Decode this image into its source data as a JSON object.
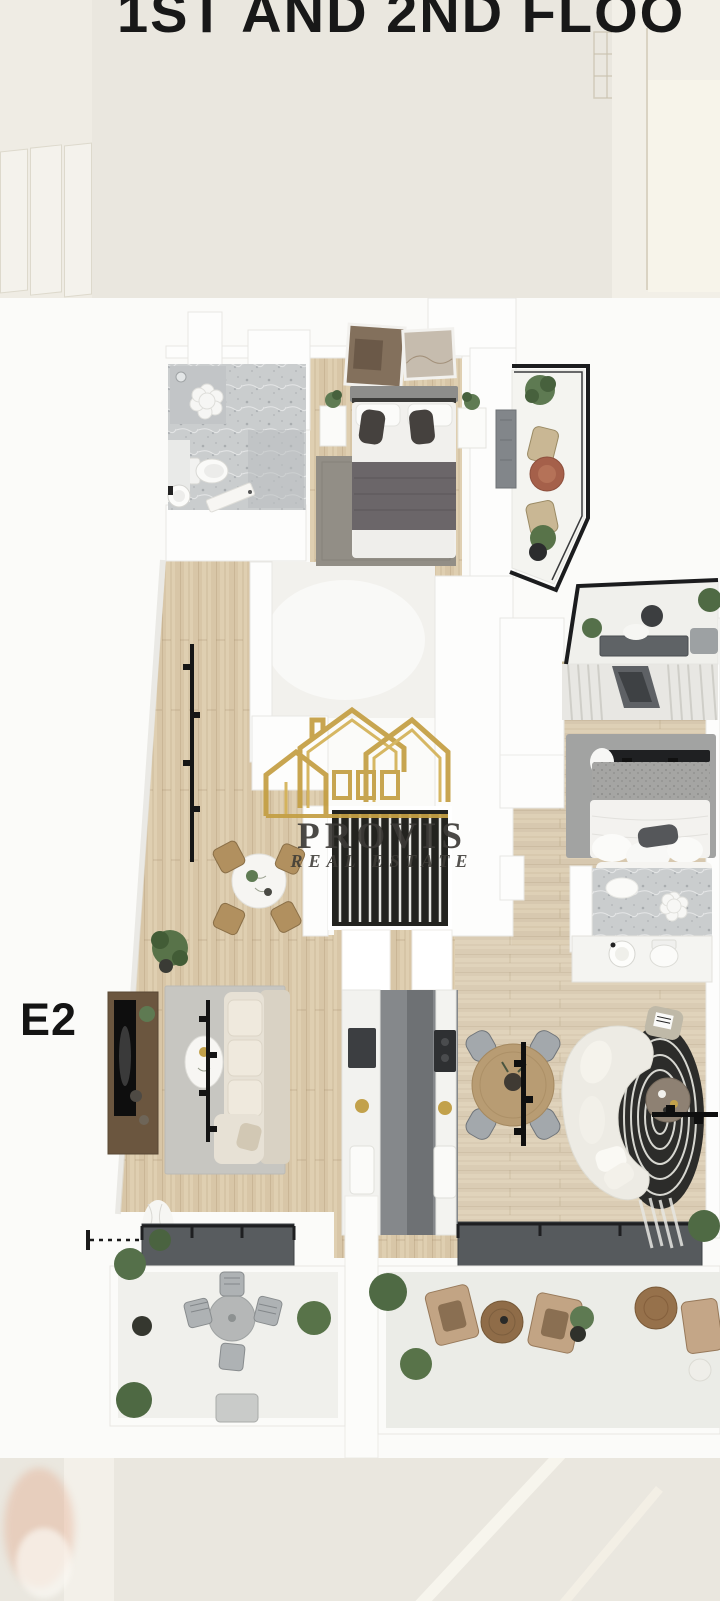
{
  "header": {
    "title": "1ST AND 2ND FLOO"
  },
  "unit": {
    "label": "E2"
  },
  "watermark": {
    "brand": "PROVIS",
    "tagline": "REAL ESTATE",
    "logo": "gold-houses-outline-icon"
  },
  "colors": {
    "background_beige": "#EAE7DF",
    "plan_background": "#FBFBF9",
    "accent_gold": "#C49F44",
    "title_text": "#181818",
    "wood_floor": "#D8C6A7",
    "railing_black": "#1B1C1E",
    "marble_grey": "#CACDCE"
  },
  "floor_plan": {
    "type": "3d-render-top-down",
    "rooms": [
      "bathroom",
      "master-bedroom",
      "master-balcony",
      "hallway",
      "empty-room",
      "breakfast-nook",
      "kitchen",
      "living-room",
      "dining-area",
      "lounge",
      "second-bedroom",
      "second-bathroom",
      "second-balcony",
      "terrace-left",
      "terrace-right"
    ]
  }
}
